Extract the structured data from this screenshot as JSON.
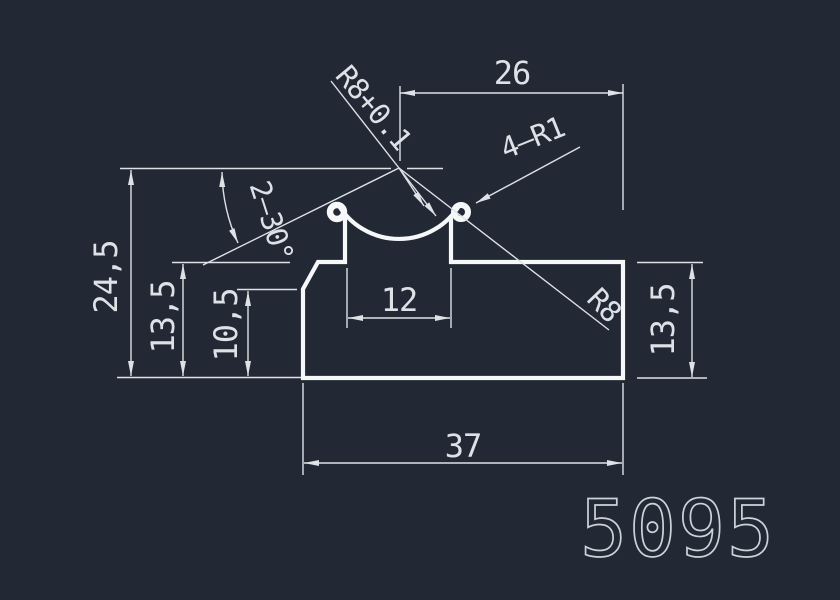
{
  "drawing": {
    "part_number": "5095",
    "type": "profile-cross-section",
    "colors": {
      "background": "#222834",
      "profile_line": "#f5f7f8",
      "dimension_line": "#dde2e7",
      "dimension_text": "#dde2e7",
      "part_number_text": "#ccd2d9"
    },
    "dimensions": {
      "top_width": "26",
      "total_height": "24,5",
      "left_height": "13,5",
      "inner_height": "10,5",
      "slot_width": "12",
      "bottom_width": "37",
      "right_height": "13,5"
    },
    "annotations": {
      "groove_radius_tol": "R8+0.1",
      "corner_radii": "4—R1",
      "groove_radius": "R8",
      "chamfer_angle": "2—30°"
    }
  }
}
